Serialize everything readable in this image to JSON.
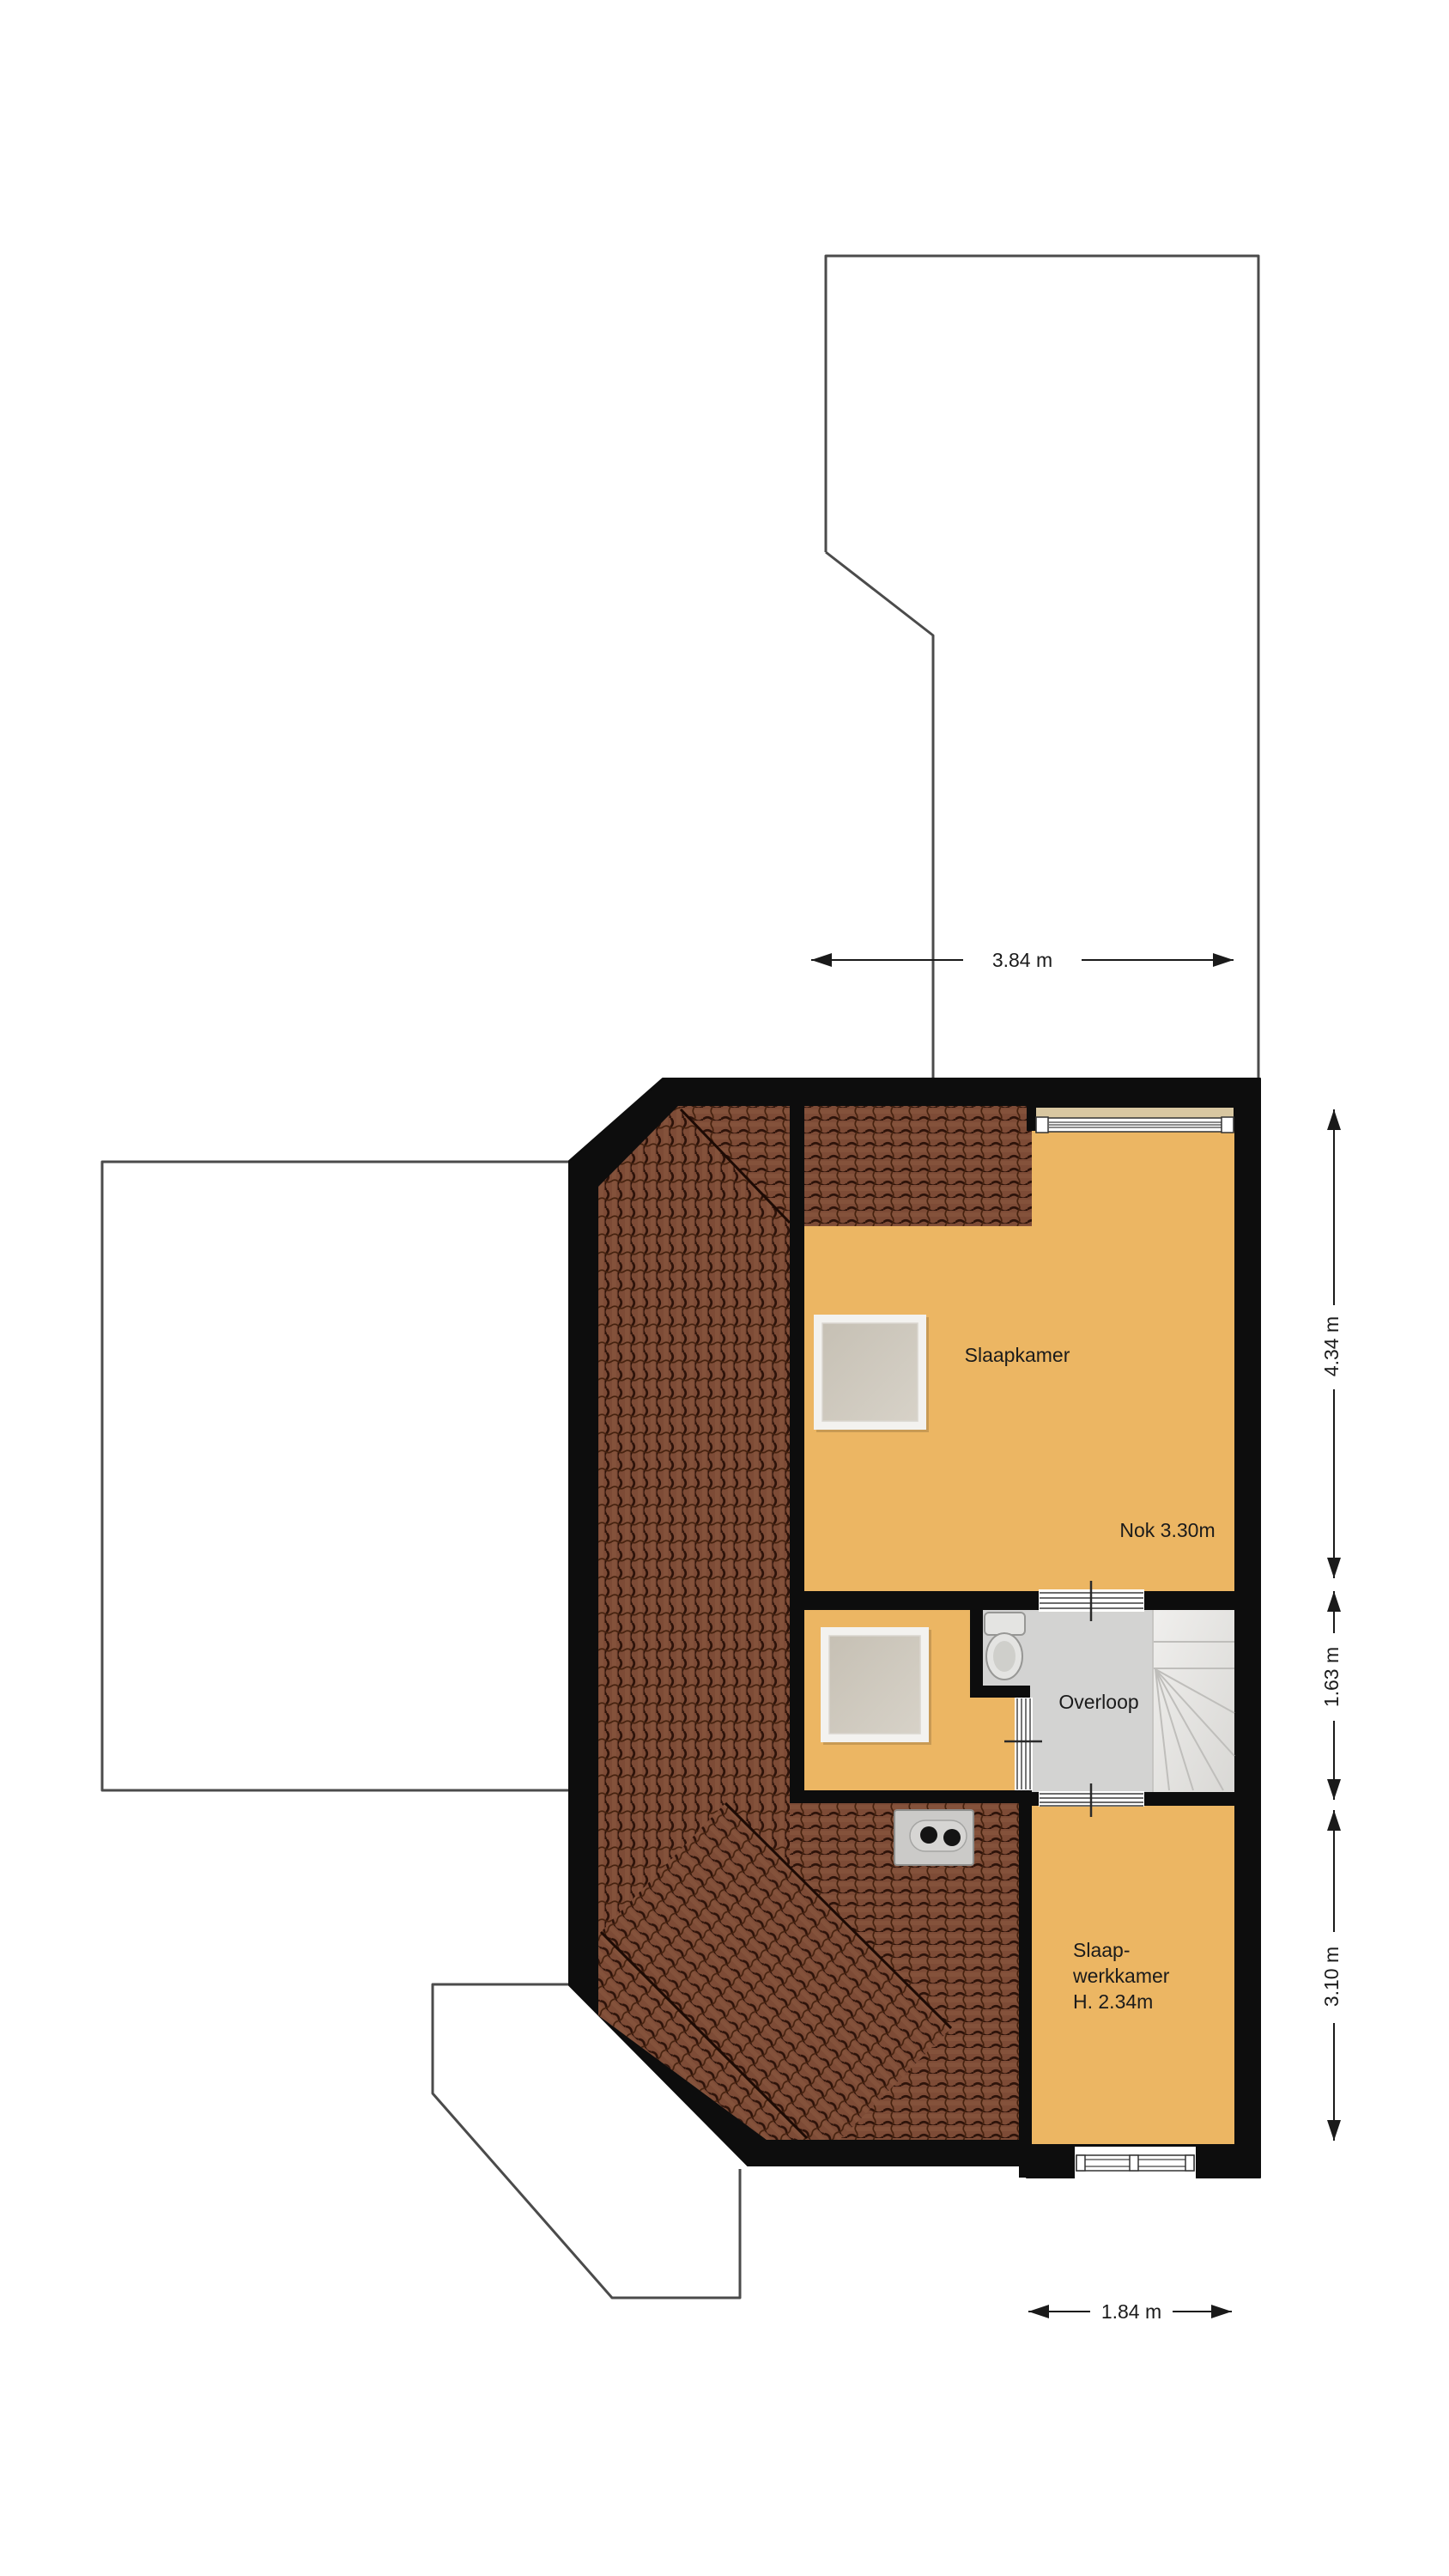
{
  "plan": {
    "rooms": {
      "slaapkamer": "Slaapkamer",
      "nok": "Nok 3.30m",
      "overloop": "Overloop",
      "werk_line1": "Slaap-",
      "werk_line2": "werkkamer",
      "werk_line3": "H. 2.34m"
    },
    "dimensions": {
      "top": "3.84 m",
      "right_top": "4.34 m",
      "right_middle": "1.63 m",
      "right_bottom": "3.10 m",
      "bottom": "1.84 m"
    },
    "colors": {
      "wall": "#0d0d0d",
      "room_floor": "#ecb663",
      "roof_tiles": "#7d4b36",
      "landing_floor": "#d3d3d2",
      "stairs": "#ebeae8",
      "outline": "#4b4b4b",
      "window_sill": "#d8c7a1",
      "dimension": "#1a1a1a"
    }
  }
}
